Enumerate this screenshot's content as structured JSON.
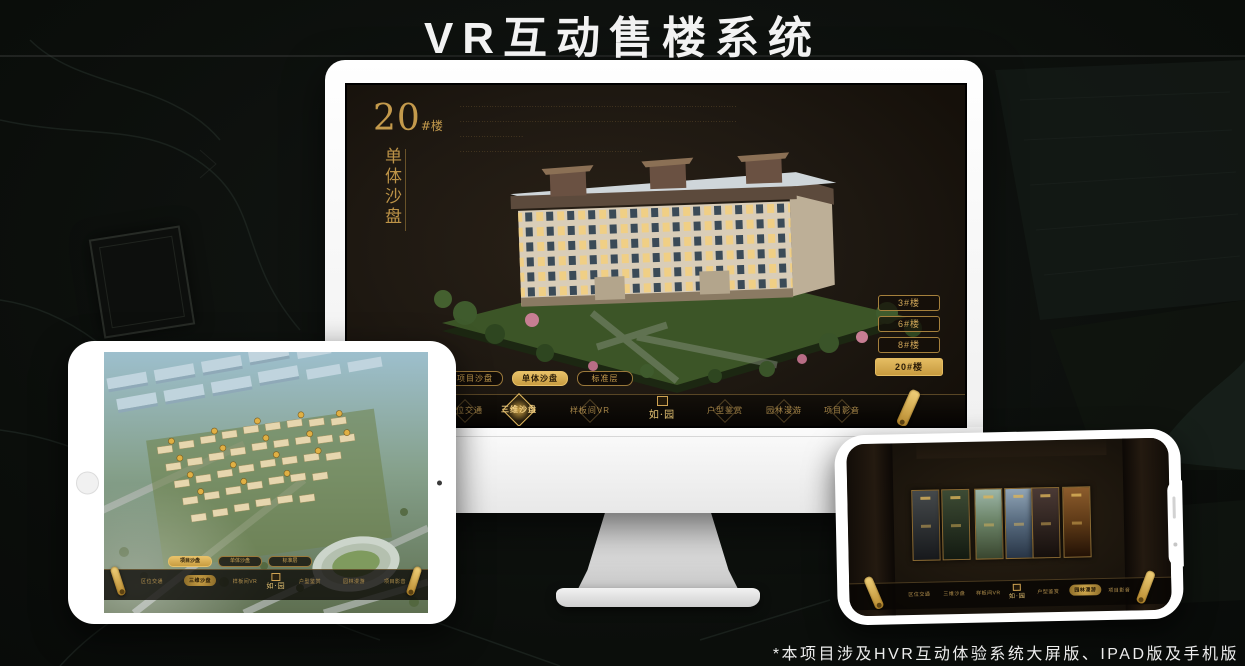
{
  "page": {
    "title": "VR互动售楼系统",
    "footnote": "*本项目涉及HVR互动体验系统大屏版、IPAD版及手机版"
  },
  "colors": {
    "accent_gold": "#d2a44e",
    "deep_gold": "#8a6a2e",
    "monitor_screen_bg": "#1f1912",
    "nav_bar_bg": "#0b0805",
    "device_white": "#f5f5f4",
    "title_white": "#f2f2f2"
  },
  "monitor_app": {
    "heading": {
      "number": "20",
      "suffix": "#楼",
      "vertical_title": "单体沙盘"
    },
    "intro_lines": [
      "········································································································",
      "········································································································",
      "········································································································",
      "········································································································"
    ],
    "floor_buttons": [
      {
        "label": "3#楼",
        "active": false
      },
      {
        "label": "6#楼",
        "active": false
      },
      {
        "label": "8#楼",
        "active": false
      },
      {
        "label": "20#楼",
        "active": true
      }
    ],
    "sub_tabs": [
      {
        "label": "项目沙盘",
        "active": false
      },
      {
        "label": "单体沙盘",
        "active": true
      },
      {
        "label": "标准层",
        "active": false
      }
    ],
    "nav_items": [
      {
        "label": "区位交通",
        "active": false
      },
      {
        "label": "三维沙盘",
        "active": true
      },
      {
        "label": "样板间VR",
        "active": false
      },
      {
        "label": "户型鉴赏",
        "active": false
      },
      {
        "label": "园林漫游",
        "active": false
      },
      {
        "label": "项目影音",
        "active": false
      }
    ],
    "logo_text": "如·园",
    "scroll_icon": "gold-scroll"
  },
  "tablet_app": {
    "pills": [
      {
        "label": "项目沙盘",
        "active": true
      },
      {
        "label": "单体沙盘",
        "active": false
      },
      {
        "label": "标准层",
        "active": false
      }
    ],
    "nav_items": [
      {
        "label": "区位交通",
        "active": false
      },
      {
        "label": "三维沙盘",
        "active": true
      },
      {
        "label": "样板间VR",
        "active": false
      },
      {
        "label": "户型鉴赏",
        "active": false
      },
      {
        "label": "园林漫游",
        "active": false
      },
      {
        "label": "项目影音",
        "active": false
      }
    ],
    "logo_text": "如·园"
  },
  "phone_app": {
    "nav_items": [
      {
        "label": "区位交通",
        "active": false
      },
      {
        "label": "三维沙盘",
        "active": false
      },
      {
        "label": "样板间VR",
        "active": false
      },
      {
        "label": "户型鉴赏",
        "active": false
      },
      {
        "label": "园林漫游",
        "active": true
      },
      {
        "label": "项目影音",
        "active": false
      }
    ],
    "logo_text": "如·园",
    "panel_scenes": [
      "courtyard",
      "garden",
      "aerial-view",
      "building-facade",
      "street-night",
      "interior"
    ]
  }
}
